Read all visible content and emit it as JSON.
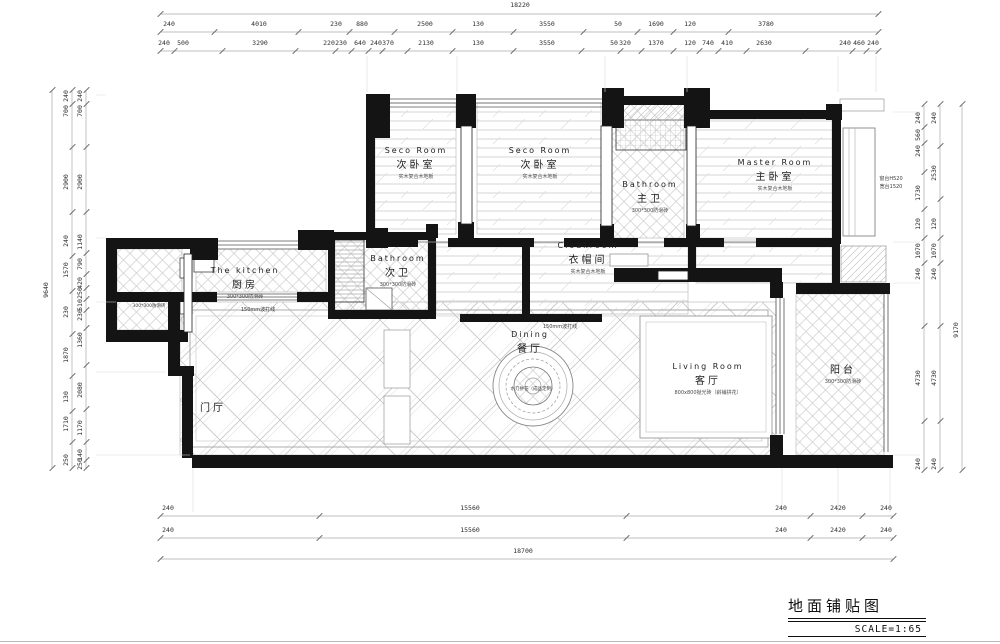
{
  "title_block": {
    "title": "地面铺贴图",
    "scale": "SCALE=1:65"
  },
  "colors": {
    "ink": "#141414",
    "hatch_gray": "#c8c8c8",
    "dim_gray": "#2d2d2d"
  },
  "rooms": [
    {
      "id": "seco-room-1",
      "en": "Seco Room",
      "zh": "次卧室",
      "note": "实木复合木地板",
      "x": 416,
      "y": 146
    },
    {
      "id": "seco-room-2",
      "en": "Seco Room",
      "zh": "次卧室",
      "note": "实木复合木地板",
      "x": 540,
      "y": 146
    },
    {
      "id": "master-bathroom",
      "en": "Bathroom",
      "zh": "主卫",
      "note": "300*300防滑砖",
      "x": 650,
      "y": 180
    },
    {
      "id": "master-room",
      "en": "Master Room",
      "zh": "主卧室",
      "note": "实木复合木地板",
      "x": 775,
      "y": 158
    },
    {
      "id": "kitchen",
      "en": "The kitchen",
      "zh": "厨房",
      "note": "300*300防滑砖",
      "x": 245,
      "y": 266
    },
    {
      "id": "second-bathroom",
      "en": "Bathroom",
      "zh": "次卫",
      "note": "300*300防滑砖",
      "x": 398,
      "y": 254
    },
    {
      "id": "cloakroom",
      "en": "Cloakroom",
      "zh": "衣帽间",
      "note": "实木复合木地板",
      "x": 588,
      "y": 241
    },
    {
      "id": "dining",
      "en": "Dining",
      "zh": "餐厅",
      "note": "",
      "x": 530,
      "y": 330
    },
    {
      "id": "living-room",
      "en": "Living Room",
      "zh": "客厅",
      "note": "800x800抛光砖（斜铺拼花）",
      "x": 708,
      "y": 362
    },
    {
      "id": "balcony",
      "en": "",
      "zh": "阳台",
      "note": "300*300防滑砖",
      "x": 843,
      "y": 360
    },
    {
      "id": "foyer",
      "en": "",
      "zh": "门厅",
      "note": "",
      "x": 213,
      "y": 398
    }
  ],
  "annotations": [
    {
      "t": "150mm波打线",
      "x": 258,
      "y": 306,
      "s": 5
    },
    {
      "t": "150mm波打线",
      "x": 560,
      "y": 323,
      "s": 5
    },
    {
      "t": "300*300防滑砖",
      "x": 149,
      "y": 303,
      "s": 4.5
    },
    {
      "t": "水刀拼花（成品定制）",
      "x": 533,
      "y": 386,
      "s": 4.5
    },
    {
      "t": "窗台H520",
      "x": 891,
      "y": 175,
      "s": 5
    },
    {
      "t": "宽台1520",
      "x": 891,
      "y": 183,
      "s": 5
    }
  ],
  "dimensions": {
    "groups": [
      {
        "id": "top-total",
        "axis": "x",
        "line": 14,
        "start": 160,
        "end": 878,
        "items": [
          {
            "t": "18220",
            "x": 520,
            "y": 1
          }
        ]
      },
      {
        "id": "top-row1",
        "axis": "x",
        "line": 32,
        "start": 160,
        "end": 878,
        "items": [
          {
            "t": "240",
            "x": 169,
            "y": 20
          },
          {
            "t": "4010",
            "x": 259,
            "y": 20
          },
          {
            "t": "230",
            "x": 336,
            "y": 20
          },
          {
            "t": "880",
            "x": 362,
            "y": 20
          },
          {
            "t": "2500",
            "x": 425,
            "y": 20
          },
          {
            "t": "130",
            "x": 478,
            "y": 20
          },
          {
            "t": "3550",
            "x": 547,
            "y": 20
          },
          {
            "t": "50",
            "x": 618,
            "y": 20
          },
          {
            "t": "1690",
            "x": 656,
            "y": 20
          },
          {
            "t": "120",
            "x": 690,
            "y": 20
          },
          {
            "t": "3780",
            "x": 766,
            "y": 20
          }
        ]
      },
      {
        "id": "top-row2",
        "axis": "x",
        "line": 51,
        "start": 160,
        "end": 878,
        "items": [
          {
            "t": "240",
            "x": 164,
            "y": 39
          },
          {
            "t": "500",
            "x": 183,
            "y": 39
          },
          {
            "t": "3290",
            "x": 260,
            "y": 39
          },
          {
            "t": "220",
            "x": 329,
            "y": 39
          },
          {
            "t": "230",
            "x": 341,
            "y": 39
          },
          {
            "t": "640",
            "x": 360,
            "y": 39
          },
          {
            "t": "240",
            "x": 376,
            "y": 39
          },
          {
            "t": "370",
            "x": 388,
            "y": 39
          },
          {
            "t": "2130",
            "x": 426,
            "y": 39
          },
          {
            "t": "130",
            "x": 478,
            "y": 39
          },
          {
            "t": "3550",
            "x": 547,
            "y": 39
          },
          {
            "t": "50",
            "x": 614,
            "y": 39
          },
          {
            "t": "320",
            "x": 625,
            "y": 39
          },
          {
            "t": "1370",
            "x": 656,
            "y": 39
          },
          {
            "t": "120",
            "x": 690,
            "y": 39
          },
          {
            "t": "740",
            "x": 708,
            "y": 39
          },
          {
            "t": "410",
            "x": 727,
            "y": 39
          },
          {
            "t": "2630",
            "x": 764,
            "y": 39
          },
          {
            "t": "240",
            "x": 845,
            "y": 39
          },
          {
            "t": "460",
            "x": 859,
            "y": 39
          },
          {
            "t": "240",
            "x": 873,
            "y": 39
          }
        ]
      },
      {
        "id": "bottom-row1",
        "axis": "x",
        "line": 516,
        "start": 160,
        "end": 893,
        "items": [
          {
            "t": "240",
            "x": 168,
            "y": 504
          },
          {
            "t": "15560",
            "x": 470,
            "y": 504
          },
          {
            "t": "240",
            "x": 781,
            "y": 504
          },
          {
            "t": "2420",
            "x": 838,
            "y": 504
          },
          {
            "t": "240",
            "x": 886,
            "y": 504
          }
        ]
      },
      {
        "id": "bottom-row2",
        "axis": "x",
        "line": 538,
        "start": 160,
        "end": 893,
        "items": [
          {
            "t": "240",
            "x": 168,
            "y": 526
          },
          {
            "t": "15560",
            "x": 470,
            "y": 526
          },
          {
            "t": "240",
            "x": 781,
            "y": 526
          },
          {
            "t": "2420",
            "x": 838,
            "y": 526
          },
          {
            "t": "240",
            "x": 886,
            "y": 526
          }
        ]
      },
      {
        "id": "bottom-total",
        "axis": "x",
        "line": 559,
        "start": 160,
        "end": 893,
        "items": [
          {
            "t": "18700",
            "x": 523,
            "y": 547
          }
        ]
      },
      {
        "id": "left-total",
        "axis": "y",
        "line": 52,
        "start": 90,
        "end": 468,
        "items": [
          {
            "t": "9640",
            "x": 46,
            "y": 290
          }
        ]
      },
      {
        "id": "left-col1",
        "axis": "y",
        "line": 72,
        "start": 90,
        "end": 468,
        "items": [
          {
            "t": "240",
            "x": 66,
            "y": 96
          },
          {
            "t": "700",
            "x": 66,
            "y": 111
          },
          {
            "t": "2900",
            "x": 66,
            "y": 182
          },
          {
            "t": "240",
            "x": 66,
            "y": 241
          },
          {
            "t": "1570",
            "x": 66,
            "y": 270
          },
          {
            "t": "230",
            "x": 66,
            "y": 312
          },
          {
            "t": "1870",
            "x": 66,
            "y": 355
          },
          {
            "t": "130",
            "x": 66,
            "y": 397
          },
          {
            "t": "1710",
            "x": 66,
            "y": 424
          },
          {
            "t": "250",
            "x": 66,
            "y": 460
          }
        ]
      },
      {
        "id": "left-col2",
        "axis": "y",
        "line": 86,
        "start": 90,
        "end": 468,
        "items": [
          {
            "t": "240",
            "x": 80,
            "y": 96
          },
          {
            "t": "700",
            "x": 80,
            "y": 111
          },
          {
            "t": "2900",
            "x": 80,
            "y": 182
          },
          {
            "t": "1140",
            "x": 80,
            "y": 242
          },
          {
            "t": "790",
            "x": 80,
            "y": 264
          },
          {
            "t": "420",
            "x": 80,
            "y": 283
          },
          {
            "t": "250",
            "x": 80,
            "y": 293
          },
          {
            "t": "510",
            "x": 80,
            "y": 305
          },
          {
            "t": "230",
            "x": 80,
            "y": 315
          },
          {
            "t": "1360",
            "x": 80,
            "y": 340
          },
          {
            "t": "2080",
            "x": 80,
            "y": 390
          },
          {
            "t": "1170",
            "x": 80,
            "y": 428
          },
          {
            "t": "140",
            "x": 80,
            "y": 455
          },
          {
            "t": "250",
            "x": 80,
            "y": 464
          }
        ]
      },
      {
        "id": "right-col1",
        "axis": "y",
        "line": 924,
        "start": 104,
        "end": 470,
        "items": [
          {
            "t": "240",
            "x": 918,
            "y": 118
          },
          {
            "t": "560",
            "x": 918,
            "y": 135
          },
          {
            "t": "240",
            "x": 918,
            "y": 151
          },
          {
            "t": "1730",
            "x": 918,
            "y": 193
          },
          {
            "t": "120",
            "x": 918,
            "y": 224
          },
          {
            "t": "1070",
            "x": 918,
            "y": 251
          },
          {
            "t": "240",
            "x": 918,
            "y": 274
          },
          {
            "t": "4730",
            "x": 918,
            "y": 378
          },
          {
            "t": "240",
            "x": 918,
            "y": 464
          }
        ]
      },
      {
        "id": "right-col2",
        "axis": "y",
        "line": 940,
        "start": 104,
        "end": 470,
        "items": [
          {
            "t": "240",
            "x": 934,
            "y": 118
          },
          {
            "t": "2530",
            "x": 934,
            "y": 173
          },
          {
            "t": "120",
            "x": 934,
            "y": 224
          },
          {
            "t": "1070",
            "x": 934,
            "y": 251
          },
          {
            "t": "240",
            "x": 934,
            "y": 274
          },
          {
            "t": "4730",
            "x": 934,
            "y": 378
          },
          {
            "t": "240",
            "x": 934,
            "y": 464
          }
        ]
      },
      {
        "id": "right-total",
        "axis": "y",
        "line": 962,
        "start": 104,
        "end": 470,
        "items": [
          {
            "t": "9170",
            "x": 956,
            "y": 330
          }
        ]
      }
    ]
  }
}
